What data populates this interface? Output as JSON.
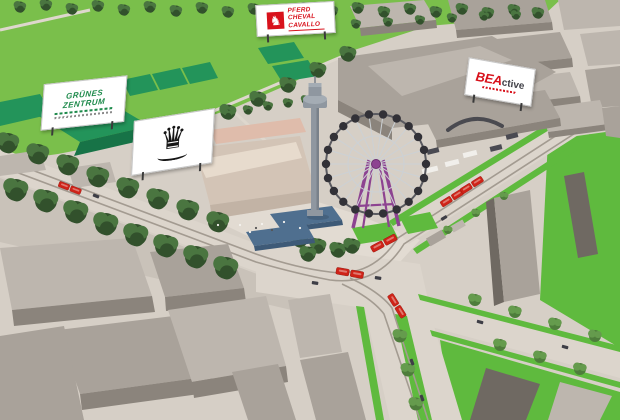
{
  "billboards": {
    "gruenes_zentrum": {
      "line1": "GRÜNES",
      "line2": "ZENTRUM"
    },
    "pferd_cheval_cavallo": {
      "line1": "PFERD",
      "line2": "CHEVAL",
      "line3": "CAVALLO",
      "horse_glyph": "♞"
    },
    "crown": {
      "glyph": "♛"
    },
    "bea_active": {
      "brand_bold": "BEA",
      "brand_rest": "ctive"
    }
  },
  "palette": {
    "ground": "#d6cfc6",
    "ground_light": "#e2dbd2",
    "field_green": "#7abf4b",
    "lawn_green": "#5fba3e",
    "tree_dark": "#32512c",
    "tree_mid": "#4a7540",
    "tree_light_a": "#4e7d3b",
    "tree_light_b": "#659b4d",
    "tent_green": "#23945a",
    "tent_green_dark": "#177347",
    "road": "#dcd5cc",
    "track_gray": "#a39b91",
    "wall_gray": "#c9c2b9",
    "building_light": "#bdb6ae",
    "building_mid": "#a9a29a",
    "building_dark": "#8b847c",
    "building_darker": "#6f6962",
    "hall_beige": "#d3c4b6",
    "hall_roof": "#e7dbcd",
    "hall_front": "#c2b3a5",
    "stall_pink": "#dfbcab",
    "tower_gray": "#8f97a0",
    "tower_light": "#a4acb4",
    "tower_shade": "#79818a",
    "wheel_purple": "#8d4391",
    "gondola_dark": "#323137",
    "spoke_gray": "#ccd1d5",
    "tram_red": "#cf2318",
    "tram_dark": "#8e150d",
    "canopy_blue": "#4f6f8f",
    "canopy_blue_dark": "#3e5a77",
    "car_dark": "#3e3e46",
    "truck_white": "#f1efeb",
    "truck_dark": "#4a4a52",
    "billboard_white": "#ffffff",
    "brand_red": "#d8121c",
    "brand_green": "#1d8a4b",
    "crown_black": "#161616",
    "sign_leg": "#3a3a3a",
    "path_light": "#ded7cd"
  }
}
